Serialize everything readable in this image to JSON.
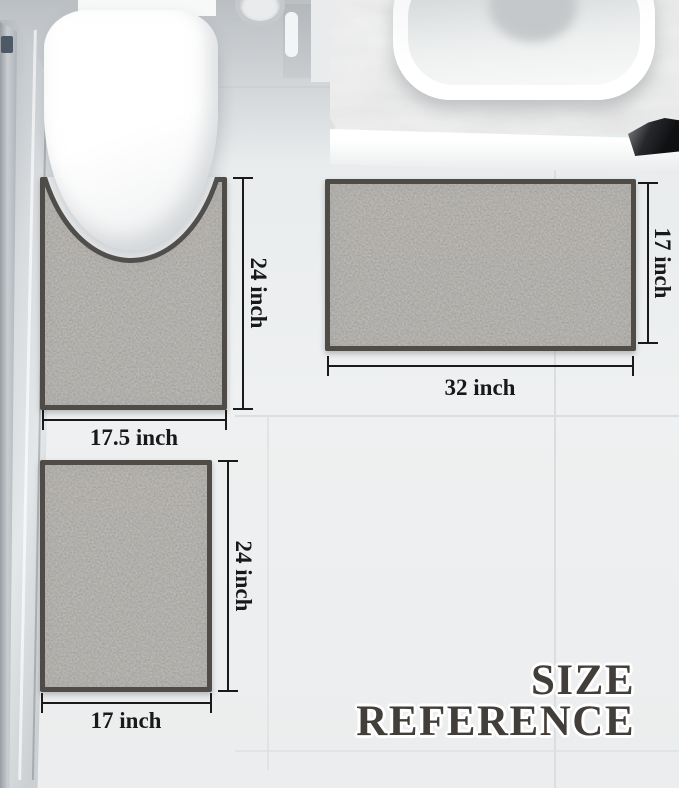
{
  "title": {
    "line1": "SIZE",
    "line2": "REFERENCE"
  },
  "rugs": [
    {
      "name": "contour-rug",
      "width_label": "17.5 inch",
      "height_label": "24 inch"
    },
    {
      "name": "large-rug",
      "width_label": "32 inch",
      "height_label": "17 inch"
    },
    {
      "name": "small-rug",
      "width_label": "17 inch",
      "height_label": "24 inch"
    }
  ],
  "colors": {
    "rug_pile": "#8b8781",
    "rug_border": "#4f4c48",
    "floor": "#eef0f1",
    "dimension_line": "#1a1a1a",
    "title_text": "#423e3a"
  }
}
